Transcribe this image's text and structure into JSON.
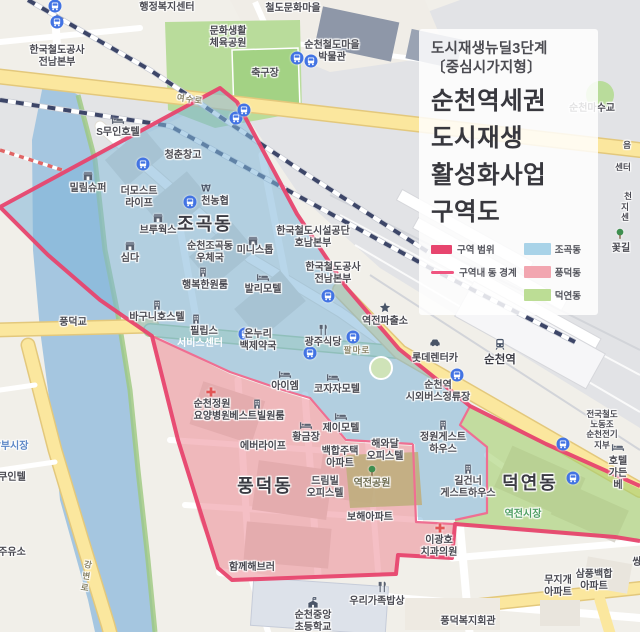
{
  "panel": {
    "subtitle": [
      "도시재생뉴딜3단계",
      "〔중심시가지형〕"
    ],
    "title": [
      "순천역세권",
      "도시재생",
      "활성화사업",
      "구역도"
    ],
    "legend": {
      "boundary": {
        "label": "구역 범위",
        "color": "#e7456e"
      },
      "inner_boundary": {
        "label": "구역내 동 경계",
        "color": "#f05580"
      },
      "zones": [
        {
          "label": "조곡동",
          "color": "#a9d3e8"
        },
        {
          "label": "풍덕동",
          "color": "#f2a6b0"
        },
        {
          "label": "덕연동",
          "color": "#bcdd95"
        }
      ]
    }
  },
  "colors": {
    "boundary": "#e7456e",
    "inner_boundary": "#ef6f92",
    "zone_jogok": "#7db4d8",
    "zone_pungdeok": "#ec8b96",
    "zone_deokyeon": "#a4cf6e",
    "water": "#a5c6e0",
    "road_main": "#fbe79e",
    "railway": "#3d4668"
  },
  "map": {
    "labels": [
      {
        "t": "행정복지센터",
        "x": 167,
        "y": 2
      },
      {
        "t": "철도문화마을",
        "x": 293,
        "y": 3
      },
      {
        "t": "문화생활\n체육공원",
        "x": 228,
        "y": 26
      },
      {
        "t": "축구장",
        "x": 265,
        "y": 68
      },
      {
        "t": "순천철도마을\n박물관",
        "x": 332,
        "y": 40
      },
      {
        "t": "한국철도공사\n전남본부",
        "x": 57,
        "y": 45
      },
      {
        "t": "S무인호텔",
        "x": 118,
        "y": 127
      },
      {
        "t": "청춘창고",
        "x": 183,
        "y": 150
      },
      {
        "t": "밀림슈퍼",
        "x": 88,
        "y": 183
      },
      {
        "t": "더모스트\n라이프",
        "x": 139,
        "y": 186
      },
      {
        "t": "천농협",
        "x": 215,
        "y": 196
      },
      {
        "t": "조곡동",
        "x": 205,
        "y": 214,
        "c": "big",
        "n": "dong-label-jogok"
      },
      {
        "t": "브루웍스",
        "x": 158,
        "y": 225
      },
      {
        "t": "심다",
        "x": 130,
        "y": 253
      },
      {
        "t": "순천조곡동\n우체국",
        "x": 210,
        "y": 241
      },
      {
        "t": "행복한원룸",
        "x": 205,
        "y": 280
      },
      {
        "t": "발리모텔",
        "x": 263,
        "y": 284
      },
      {
        "t": "미니스톱",
        "x": 255,
        "y": 245
      },
      {
        "t": "한국철도시설공단\n호남본부",
        "x": 313,
        "y": 226
      },
      {
        "t": "한국철도공사\n전남본부",
        "x": 333,
        "y": 262
      },
      {
        "t": "역전파출소",
        "x": 385,
        "y": 316
      },
      {
        "t": "바구니호스텔",
        "x": 157,
        "y": 312
      },
      {
        "t": "풍덕교",
        "x": 73,
        "y": 317
      },
      {
        "t": "필립스",
        "x": 204,
        "y": 326
      },
      {
        "t": "서비스센터",
        "x": 200,
        "y": 338,
        "c": "whitelbl"
      },
      {
        "t": "온누리\n백제약국",
        "x": 258,
        "y": 329
      },
      {
        "t": "광주식당",
        "x": 323,
        "y": 337
      },
      {
        "t": "팔마로",
        "x": 357,
        "y": 345,
        "c": "road"
      },
      {
        "t": "코자자모텔",
        "x": 337,
        "y": 384
      },
      {
        "t": "아이엠",
        "x": 285,
        "y": 381
      },
      {
        "t": "순천정원\n요양병원",
        "x": 212,
        "y": 399
      },
      {
        "t": "베스트빌원룸",
        "x": 257,
        "y": 411
      },
      {
        "t": "황금장",
        "x": 306,
        "y": 432
      },
      {
        "t": "제이모텔",
        "x": 341,
        "y": 423
      },
      {
        "t": "에버라이프",
        "x": 263,
        "y": 441
      },
      {
        "t": "백합주택\n아파트",
        "x": 340,
        "y": 446
      },
      {
        "t": "풍덕동",
        "x": 265,
        "y": 476,
        "c": "big",
        "n": "dong-label-pungdeok"
      },
      {
        "t": "드림빌\n오피스텔",
        "x": 325,
        "y": 476
      },
      {
        "t": "역전공원",
        "x": 372,
        "y": 478,
        "c": "parklbl"
      },
      {
        "t": "해와달\n오피스텔",
        "x": 385,
        "y": 439
      },
      {
        "t": "정원게스트\n하우스",
        "x": 443,
        "y": 432
      },
      {
        "t": "길건너\n게스트하우스",
        "x": 468,
        "y": 476
      },
      {
        "t": "덕연동",
        "x": 530,
        "y": 473,
        "c": "big",
        "n": "dong-label-deokyeon"
      },
      {
        "t": "역전시장",
        "x": 523,
        "y": 509,
        "c": "mgreen"
      },
      {
        "t": "이광호\n치과의원",
        "x": 439,
        "y": 535
      },
      {
        "t": "보해아파트",
        "x": 370,
        "y": 512
      },
      {
        "t": "함께해브러",
        "x": 252,
        "y": 562
      },
      {
        "t": "우리가족밥상",
        "x": 377,
        "y": 596
      },
      {
        "t": "순천중앙\n초등학교",
        "x": 313,
        "y": 610
      },
      {
        "t": "풍덕복지회관",
        "x": 468,
        "y": 616
      },
      {
        "t": "무지개\n아파트",
        "x": 558,
        "y": 575
      },
      {
        "t": "삼풍백합\n아파트",
        "x": 594,
        "y": 569
      },
      {
        "t": "쌍",
        "x": 637,
        "y": 557
      },
      {
        "t": "순천역",
        "x": 500,
        "y": 354,
        "c": "station",
        "n": "station-label"
      },
      {
        "t": "롯데렌터카",
        "x": 435,
        "y": 353
      },
      {
        "t": "순천역\n시외버스정류장",
        "x": 438,
        "y": 380
      },
      {
        "t": "전국철도노동조\n순천전기지부",
        "x": 602,
        "y": 409,
        "c": "small9"
      },
      {
        "t": "호텔가든베",
        "x": 618,
        "y": 456
      },
      {
        "t": "남부시장",
        "x": 10,
        "y": 441,
        "c": "mblue"
      },
      {
        "t": "쿠인텔",
        "x": 12,
        "y": 472
      },
      {
        "t": "주유소",
        "x": 12,
        "y": 547
      },
      {
        "t": "강변로",
        "x": 86,
        "y": 560,
        "c": "road vert"
      },
      {
        "t": "여수로",
        "x": 190,
        "y": 94,
        "c": "road rot"
      },
      {
        "t": "꽃길",
        "x": 621,
        "y": 243
      },
      {
        "t": "음",
        "x": 627,
        "y": 140,
        "c": "small9"
      },
      {
        "t": "센터",
        "x": 623,
        "y": 162,
        "c": "small9"
      },
      {
        "t": "천",
        "x": 628,
        "y": 191,
        "c": "small9"
      },
      {
        "t": "지센",
        "x": 625,
        "y": 202,
        "c": "small9"
      },
      {
        "t": "순천마수교",
        "x": 592,
        "y": 103
      }
    ],
    "icons": [
      {
        "t": "bus",
        "x": 55,
        "y": 6
      },
      {
        "t": "bus",
        "x": 57,
        "y": 22
      },
      {
        "t": "bus",
        "x": 297,
        "y": 58
      },
      {
        "t": "bus",
        "x": 311,
        "y": 61
      },
      {
        "t": "bus",
        "x": 236,
        "y": 118
      },
      {
        "t": "bus",
        "x": 244,
        "y": 110
      },
      {
        "t": "bus",
        "x": 143,
        "y": 164
      },
      {
        "t": "bus",
        "x": 190,
        "y": 202
      },
      {
        "t": "bus",
        "x": 328,
        "y": 296
      },
      {
        "t": "bus",
        "x": 245,
        "y": 334
      },
      {
        "t": "bus",
        "x": 310,
        "y": 353
      },
      {
        "t": "bus",
        "x": 353,
        "y": 337
      },
      {
        "t": "bus",
        "x": 457,
        "y": 375
      },
      {
        "t": "bus",
        "x": 563,
        "y": 444
      },
      {
        "t": "bus",
        "x": 573,
        "y": 478
      },
      {
        "t": "bed",
        "x": 118,
        "y": 120
      },
      {
        "t": "bed",
        "x": 263,
        "y": 277
      },
      {
        "t": "bed",
        "x": 285,
        "y": 374
      },
      {
        "t": "bed",
        "x": 333,
        "y": 377
      },
      {
        "t": "bed",
        "x": 306,
        "y": 425
      },
      {
        "t": "bed",
        "x": 341,
        "y": 416
      },
      {
        "t": "bed",
        "x": 618,
        "y": 447
      },
      {
        "t": "bldg",
        "x": 157,
        "y": 305
      },
      {
        "t": "bldg",
        "x": 203,
        "y": 272
      },
      {
        "t": "bldg",
        "x": 257,
        "y": 404
      },
      {
        "t": "bldg",
        "x": 443,
        "y": 425
      },
      {
        "t": "bldg",
        "x": 468,
        "y": 469
      },
      {
        "t": "bldg",
        "x": 196,
        "y": 319
      },
      {
        "t": "won",
        "x": 206,
        "y": 188
      },
      {
        "t": "shop",
        "x": 88,
        "y": 176
      },
      {
        "t": "shop",
        "x": 130,
        "y": 246
      },
      {
        "t": "shop",
        "x": 158,
        "y": 218
      },
      {
        "t": "shop",
        "x": 235,
        "y": 565
      },
      {
        "t": "shop",
        "x": 253,
        "y": 241
      },
      {
        "t": "fork",
        "x": 323,
        "y": 330
      },
      {
        "t": "fork",
        "x": 382,
        "y": 587
      },
      {
        "t": "cross",
        "x": 211,
        "y": 392
      },
      {
        "t": "cross",
        "x": 440,
        "y": 528
      },
      {
        "t": "police",
        "x": 385,
        "y": 308
      },
      {
        "t": "train",
        "x": 500,
        "y": 344
      },
      {
        "t": "car",
        "x": 435,
        "y": 343
      },
      {
        "t": "school",
        "x": 313,
        "y": 603
      },
      {
        "t": "tree",
        "x": 372,
        "y": 471
      },
      {
        "t": "tree",
        "x": 620,
        "y": 234
      }
    ]
  }
}
